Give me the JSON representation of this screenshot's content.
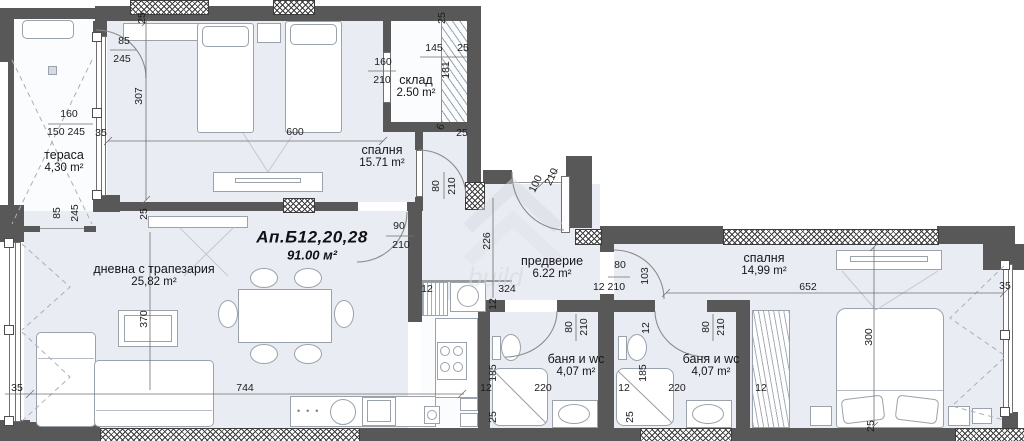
{
  "title": {
    "name": "Ап.Б12,20,28",
    "area": "91.00 м²"
  },
  "watermark": "build",
  "colors": {
    "floor": "#e9ecf3",
    "wall": "#585858",
    "hatch": "#3c3c3c",
    "dimension_text": "#1c1c1c"
  },
  "rooms": [
    {
      "id": "terrace",
      "name": "тераса",
      "area": "4,30 m²",
      "x": 64,
      "y": 162
    },
    {
      "id": "bedroom-1",
      "name": "спалня",
      "area": "15.71 m²",
      "x": 382,
      "y": 157
    },
    {
      "id": "storage",
      "name": "склад",
      "area": "2.50 m²",
      "x": 416,
      "y": 87
    },
    {
      "id": "living-dining",
      "name": "дневна с трапезария",
      "area": "25,82 m²",
      "x": 154,
      "y": 276
    },
    {
      "id": "entry-hall",
      "name": "предверие",
      "area": "6.22 m²",
      "x": 552,
      "y": 268
    },
    {
      "id": "bathroom-1",
      "name": "баня и wc",
      "area": "4,07 m²",
      "x": 576,
      "y": 366
    },
    {
      "id": "bathroom-2",
      "name": "баня и wc",
      "area": "4,07 m²",
      "x": 711,
      "y": 366
    },
    {
      "id": "bedroom-2",
      "name": "спалня",
      "area": "14,99 m²",
      "x": 764,
      "y": 265
    }
  ],
  "dimensions": [
    {
      "t": "25",
      "x": 142,
      "y": 18,
      "r": -90
    },
    {
      "t": "85",
      "x": 124,
      "y": 41,
      "r": 0
    },
    {
      "t": "245",
      "x": 122,
      "y": 59,
      "r": 0
    },
    {
      "t": "307",
      "x": 139,
      "y": 96,
      "r": -90
    },
    {
      "t": "160",
      "x": 69,
      "y": 114,
      "r": 0
    },
    {
      "t": "150 245",
      "x": 66,
      "y": 132,
      "r": 0
    },
    {
      "t": "35",
      "x": 101,
      "y": 133,
      "r": 0
    },
    {
      "t": "600",
      "x": 295,
      "y": 132,
      "r": 0
    },
    {
      "t": "145",
      "x": 434,
      "y": 48,
      "r": 0
    },
    {
      "t": "25",
      "x": 463,
      "y": 48,
      "r": 0
    },
    {
      "t": "181",
      "x": 446,
      "y": 70,
      "r": -90
    },
    {
      "t": "160",
      "x": 383,
      "y": 62,
      "r": 0
    },
    {
      "t": "210",
      "x": 382,
      "y": 80,
      "r": 0
    },
    {
      "t": "25",
      "x": 442,
      "y": 18,
      "r": -90
    },
    {
      "t": "6",
      "x": 441,
      "y": 127,
      "r": -70
    },
    {
      "t": "25",
      "x": 462,
      "y": 133,
      "r": 0
    },
    {
      "t": "80",
      "x": 436,
      "y": 186,
      "r": -90
    },
    {
      "t": "210",
      "x": 452,
      "y": 186,
      "r": -90
    },
    {
      "t": "85",
      "x": 57,
      "y": 213,
      "r": -90
    },
    {
      "t": "245",
      "x": 75,
      "y": 213,
      "r": -90
    },
    {
      "t": "25",
      "x": 144,
      "y": 214,
      "r": -90
    },
    {
      "t": "90",
      "x": 399,
      "y": 226,
      "r": 0
    },
    {
      "t": "210",
      "x": 401,
      "y": 245,
      "r": 0
    },
    {
      "t": "100",
      "x": 536,
      "y": 184,
      "r": -65
    },
    {
      "t": "210",
      "x": 552,
      "y": 177,
      "r": -65
    },
    {
      "t": "226",
      "x": 487,
      "y": 241,
      "r": -90
    },
    {
      "t": "370",
      "x": 144,
      "y": 319,
      "r": -90
    },
    {
      "t": "35",
      "x": 17,
      "y": 388,
      "r": 0
    },
    {
      "t": "744",
      "x": 245,
      "y": 388,
      "r": 0
    },
    {
      "t": "12",
      "x": 427,
      "y": 289,
      "r": 0
    },
    {
      "t": "324",
      "x": 507,
      "y": 289,
      "r": 0
    },
    {
      "t": "12",
      "x": 493,
      "y": 304,
      "r": -90
    },
    {
      "t": "80",
      "x": 620,
      "y": 265,
      "r": 0
    },
    {
      "t": "12 210",
      "x": 609,
      "y": 287,
      "r": 0
    },
    {
      "t": "103",
      "x": 645,
      "y": 276,
      "r": -90
    },
    {
      "t": "12",
      "x": 646,
      "y": 328,
      "r": -90
    },
    {
      "t": "80",
      "x": 569,
      "y": 327,
      "r": -90
    },
    {
      "t": "210",
      "x": 584,
      "y": 327,
      "r": -90
    },
    {
      "t": "185",
      "x": 493,
      "y": 373,
      "r": -90
    },
    {
      "t": "12",
      "x": 486,
      "y": 388,
      "r": 0
    },
    {
      "t": "220",
      "x": 543,
      "y": 388,
      "r": 0
    },
    {
      "t": "25",
      "x": 493,
      "y": 417,
      "r": -90
    },
    {
      "t": "80",
      "x": 706,
      "y": 327,
      "r": -90
    },
    {
      "t": "210",
      "x": 721,
      "y": 327,
      "r": -90
    },
    {
      "t": "185",
      "x": 643,
      "y": 373,
      "r": -90
    },
    {
      "t": "12",
      "x": 624,
      "y": 388,
      "r": 0
    },
    {
      "t": "220",
      "x": 677,
      "y": 388,
      "r": 0
    },
    {
      "t": "25",
      "x": 630,
      "y": 417,
      "r": -90
    },
    {
      "t": "652",
      "x": 808,
      "y": 287,
      "r": 0
    },
    {
      "t": "35",
      "x": 1005,
      "y": 286,
      "r": 0
    },
    {
      "t": "300",
      "x": 869,
      "y": 337,
      "r": -90
    },
    {
      "t": "12",
      "x": 761,
      "y": 388,
      "r": 0
    },
    {
      "t": "25",
      "x": 871,
      "y": 426,
      "r": -90
    }
  ]
}
